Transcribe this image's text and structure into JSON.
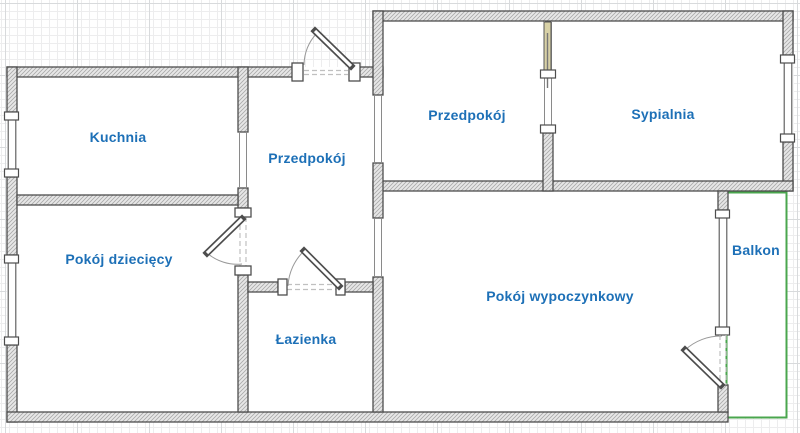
{
  "plan": {
    "title": "apartment-floor-plan",
    "rooms": [
      {
        "id": "kuchnia",
        "label": "Kuchnia"
      },
      {
        "id": "przedpokoj-center",
        "label": "Przedpokój"
      },
      {
        "id": "przedpokoj-north",
        "label": "Przedpokój"
      },
      {
        "id": "sypialnia",
        "label": "Sypialnia"
      },
      {
        "id": "pokoj-dzieciecy",
        "label": "Pokój dziecięcy"
      },
      {
        "id": "lazienka",
        "label": "Łazienka"
      },
      {
        "id": "pokoj-wypoczynkowy",
        "label": "Pokój wypoczynkowy"
      },
      {
        "id": "balkon",
        "label": "Balkon"
      }
    ],
    "colors": {
      "label": "#1d70b7",
      "wall_edge": "#4d4d4d",
      "balcony_border": "#4aa64e",
      "door_leaf_wood": "#d8d1a6",
      "door_arc": "#999999",
      "threshold_dash": "#c0c0c0"
    }
  }
}
